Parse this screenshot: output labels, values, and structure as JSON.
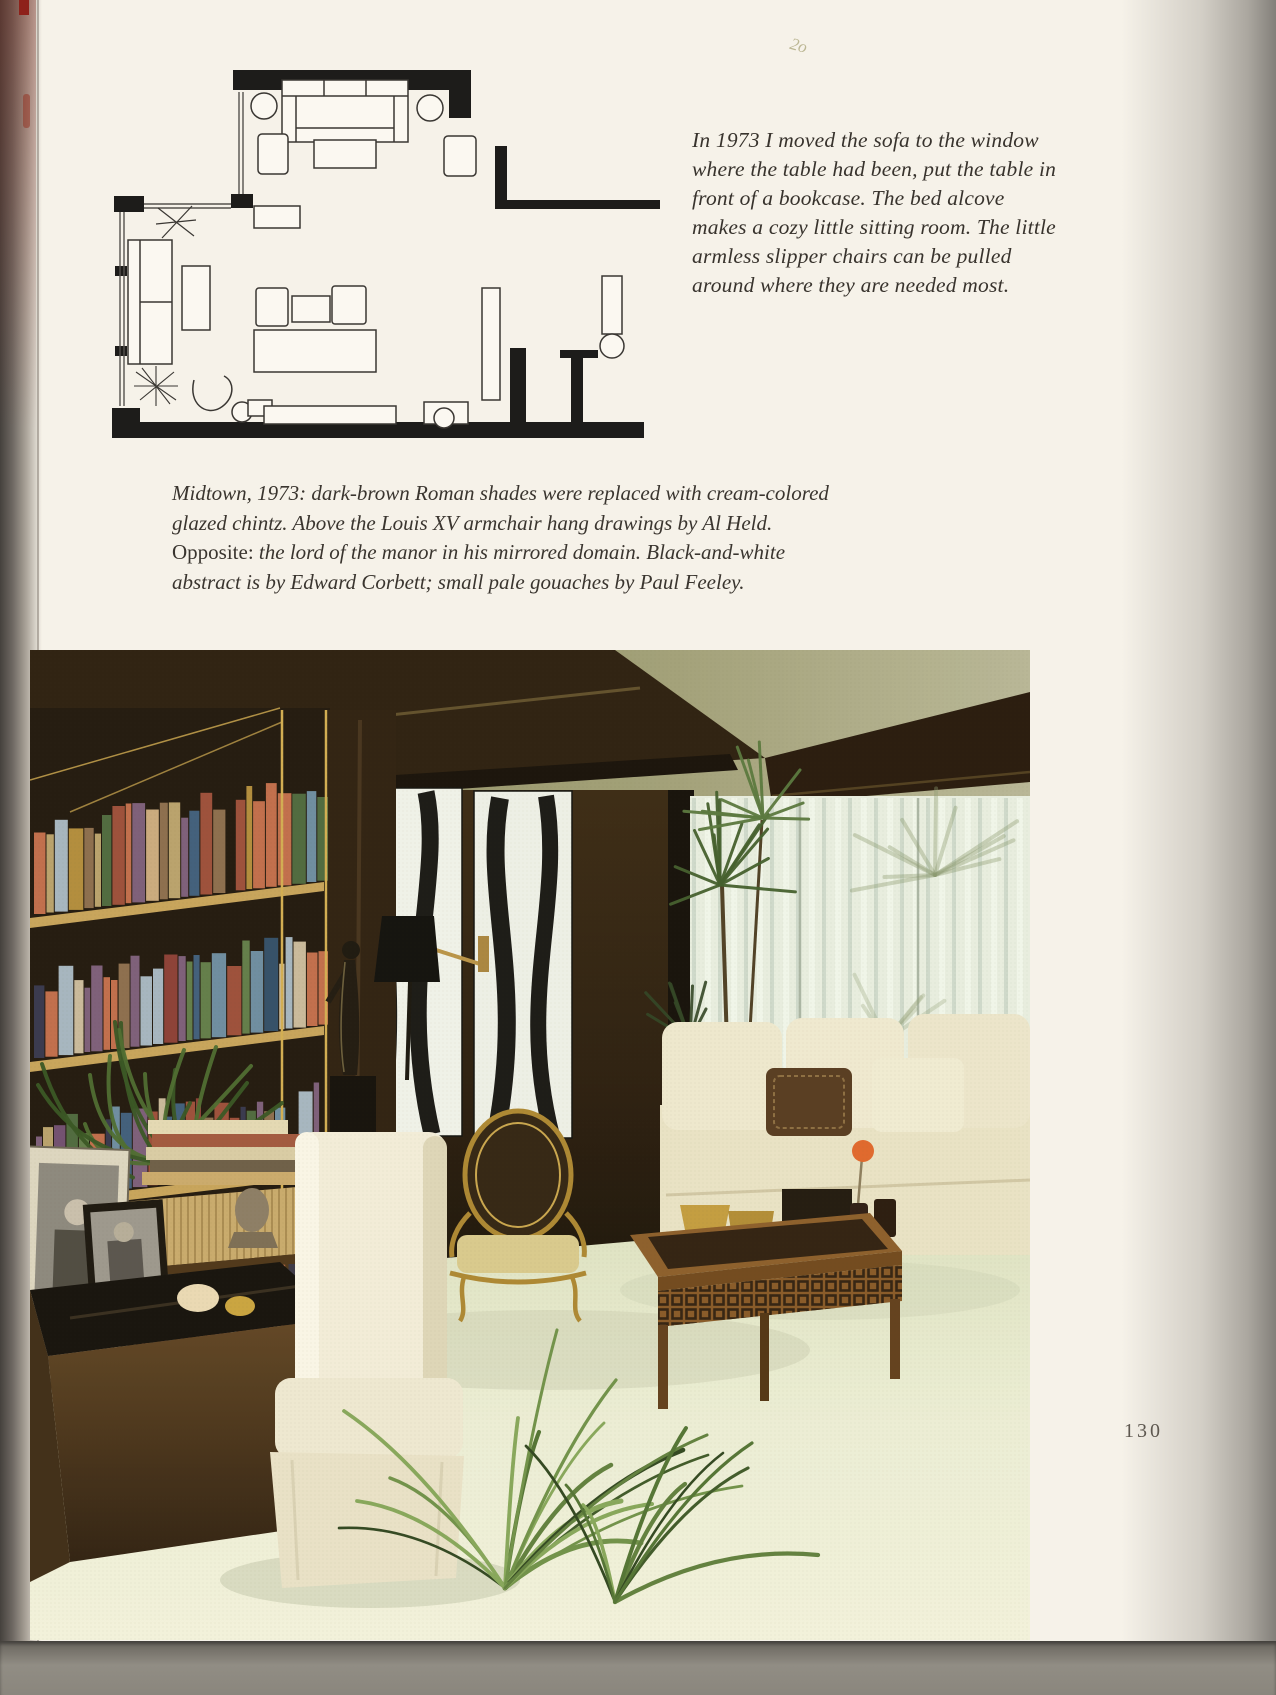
{
  "page": {
    "number": "130",
    "pencil_mark": "2o"
  },
  "intro": {
    "lines": [
      "In 1973 I moved the sofa to the window",
      "where the table had been, put the table in",
      "front of a bookcase. The bed alcove",
      "makes a cozy little sitting room. The little",
      "armless slipper chairs can be pulled",
      "around where they are needed most."
    ]
  },
  "caption": {
    "lines": [
      {
        "roman": "",
        "italic": "Midtown, 1973: dark-brown Roman shades were replaced with cream-colored"
      },
      {
        "roman": "",
        "italic": "glazed chintz. Above the Louis XV armchair hang drawings by Al Held."
      },
      {
        "roman": "Opposite:",
        "italic": " the lord of the manor in his mirrored domain. Black-and-white"
      },
      {
        "roman": "",
        "italic": "abstract is by Edward Corbett; small pale gouaches by Paul Feeley."
      }
    ]
  },
  "palette": {
    "paper": "#f6f2e9",
    "ink": "#38332d",
    "plan_wall": "#1d1c1a",
    "plan_line": "#3a3733",
    "photo_wall_brown": "#2b1c0e",
    "carpet_celadon": "#e7eacd",
    "sofa_cream": "#eee7cf",
    "gilt_brass": "#ab842e",
    "blind_cream": "#e8eee1",
    "book_colors": [
      "#9a4a36",
      "#c06a48",
      "#5a7a99",
      "#3c5a7a",
      "#5e7a46",
      "#b8a06a",
      "#7a5a78",
      "#32324a",
      "#b08a38",
      "#8a3a32",
      "#6a8aa0",
      "#4a663a",
      "#caa87c",
      "#2e4a66",
      "#8a6a4a",
      "#a4b4c0",
      "#6e4a6e",
      "#c9b89a"
    ],
    "palm_greens": [
      "#4f7030",
      "#6d8f46",
      "#3a5524",
      "#84a558",
      "#2c421c",
      "#5d7d3a"
    ]
  }
}
